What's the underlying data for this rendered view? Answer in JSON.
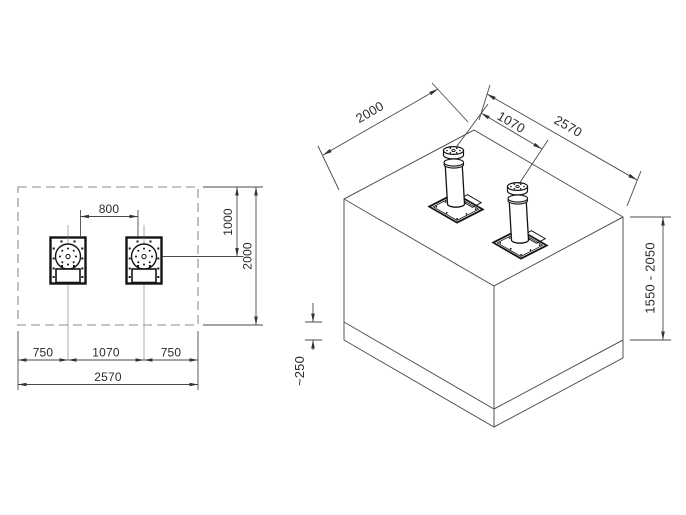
{
  "drawing": {
    "plan": {
      "clearance": "800",
      "left_edge": "750",
      "spacing": "1070",
      "right_edge": "750",
      "total_width": "2570",
      "center_offset": "1000",
      "total_depth": "2000"
    },
    "iso": {
      "depth": "2000",
      "spacing": "1070",
      "width": "2570",
      "install_height": "1550 - 2050",
      "surface_layer": "~250"
    },
    "colors": {
      "background": "#ffffff",
      "object_line": "#141414",
      "construction_line": "#4a4a4a",
      "dashed_outline": "#8c8c8c",
      "text": "#2b2b2b"
    }
  }
}
